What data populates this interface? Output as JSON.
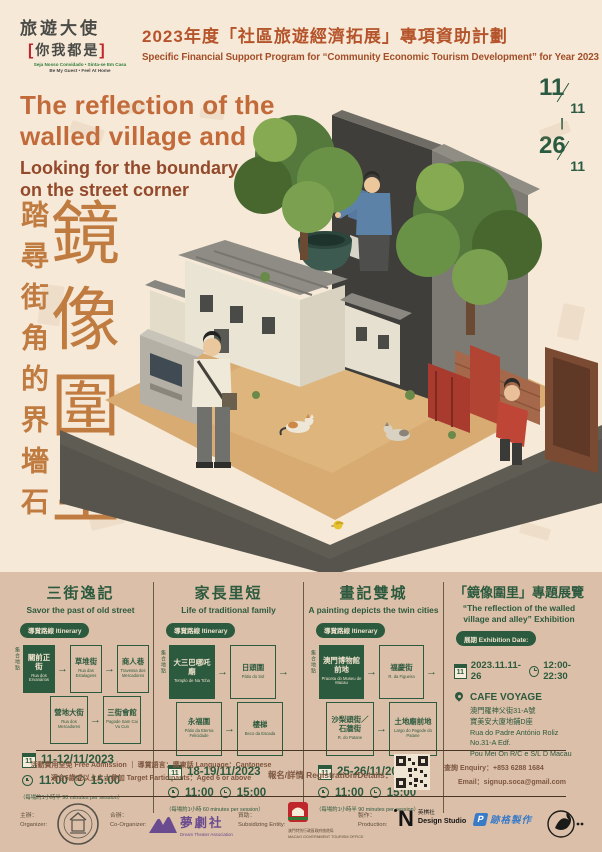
{
  "header": {
    "logo": {
      "title": "旅遊大使",
      "bracket_l": "[",
      "sub_cn": "你我都是",
      "bracket_r": "]",
      "pt": "Seja Nosso Convidado • Sinta-se Em Casa",
      "en": "Be My Guest • Feel At Home"
    },
    "title_cn": "2023年度「社區旅遊經濟拓展」專項資助計劃",
    "title_en": "Specific Financial Support Program for “Community Economic Tourism Development” for Year 2023"
  },
  "hero": {
    "title_line1": "The reflection of the",
    "title_line2": "walled village and alley",
    "subtitle_line1": "Looking for the boundary stone",
    "subtitle_line2": "on the street corner",
    "vertical_sub": "踏尋街角的界墻石",
    "vertical_main": "鏡像圍里",
    "date": {
      "d1": "11",
      "m1": "11",
      "sep": "|",
      "d2": "26",
      "m2": "11"
    }
  },
  "misc": {
    "arrow": "→",
    "calendar_day": "11"
  },
  "sections": {
    "col1": {
      "title_cn": "三街逸記",
      "title_en": "Savor the past of old street",
      "badge": "導賞路線 Itinerary",
      "meeting_label": "集合地點",
      "row1": [
        {
          "cn": "關前正街",
          "latin": "Rua dos Ervanários"
        },
        {
          "cn": "草堆街",
          "latin": "Rua das Estalagens"
        },
        {
          "cn": "商人巷",
          "latin": "Travessa dos Mercadores"
        }
      ],
      "row2": [
        {
          "cn": "營地大街",
          "latin": "Rua dos Mercadores"
        },
        {
          "cn": "三街會館",
          "latin": "Pagode Sam Cai Vu Cun"
        }
      ],
      "date": "11-12/11/2023",
      "time1": "11:00",
      "time2": "15:00",
      "note": "（每場約1小時半 90 minutes per session）"
    },
    "col2": {
      "title_cn": "家長里短",
      "title_en": "Life of traditional family",
      "badge": "導賞路線 Itinerary",
      "meeting_label": "集合地點",
      "row1": [
        {
          "cn": "大三巴哪吒廟",
          "latin": "Templo de Na Tcha"
        },
        {
          "cn": "日頭圍",
          "latin": "Pátio do Sol"
        }
      ],
      "row2": [
        {
          "cn": "永福圍",
          "latin": "Pátio da Eterna Felicidade"
        },
        {
          "cn": "樓梯",
          "latin": "Beco da Escada"
        }
      ],
      "date": "18-19/11/2023",
      "time1": "11:00",
      "time2": "15:00",
      "note": "（每場約1小時 60 minutes per session）"
    },
    "col3": {
      "title_cn": "畫記雙城",
      "title_en": "A painting depicts the twin cities",
      "badge": "導賞路線 Itinerary",
      "meeting_label": "集合地點",
      "row1": [
        {
          "cn": "澳門博物館前地",
          "latin": "Praceta do Museu de Macau"
        },
        {
          "cn": "福慶街",
          "latin": "R. da Figueira"
        }
      ],
      "row2": [
        {
          "cn": "沙梨頭街／石牆街",
          "latin": "R. do Patane"
        },
        {
          "cn": "土地廟前地",
          "latin": "Largo do Pagode do Patane"
        }
      ],
      "date": "25-26/11/2023",
      "time1": "11:00",
      "time2": "15:00",
      "note": "（每場約1小時半 90 minutes per session）"
    },
    "col4": {
      "title_cn": "「鏡像圍里」專題展覽",
      "title_en_line1": "“The reflection of the walled",
      "title_en_line2": "village and alley” Exhibition",
      "badge": "展期 Exhibition Date:",
      "date": "2023.11.11-26",
      "time": "12:00-22:30",
      "venue": "CAFE VOYAGE",
      "addr_cn1": "澳門羅神父街31-A號",
      "addr_cn2": "寶美安大廈地鋪D座",
      "addr_pt1": "Rua do Padre António Roliz",
      "addr_pt2": "No.31-A Edf.",
      "addr_pt3": "Pou Mei On R/C e S/L D Macau"
    }
  },
  "registration": {
    "line1": "活動費用全免 Free Admission ｜ 導賞語言：廣東話 Language：Cantonese",
    "line2": "適合6歲或以上人士參加 Target Participants：Aged 6 or above",
    "reg_label": "報名/詳情 Registration/Details：",
    "enquiry": "查詢 Enquiry：+853 6288 1684",
    "email": "Email：signup.soca@gmail.com"
  },
  "footer": {
    "organizer_cn": "主辦：",
    "organizer_en": "Organizer:",
    "coorganizer_cn": "合辦：",
    "coorganizer_en": "Co-Organizer:",
    "coorganizer_name_cn": "夢劇社",
    "coorganizer_name_en": "Dream Theater Association",
    "subsidy_cn": "資助：",
    "subsidy_en": "Subsidizing Entity:",
    "subsidy_name_cn": "澳門特別行政區政府旅遊局",
    "subsidy_name_en": "MACAO GOVERNMENT TOURISM OFFICE",
    "production_cn": "製作：",
    "production_en": "Production:",
    "production_name_cn": "英棋社",
    "production_name_en": "Design Studio",
    "production2_name": "跡格製作"
  },
  "colors": {
    "bg_top": "#f6e9d8",
    "bg_bottom": "#dbbfa8",
    "accent_orange": "#c26a39",
    "dark_brown": "#93492a",
    "header_orange": "#b5542b",
    "green": "#2c5a3e",
    "logo_red": "#c0272d",
    "purple": "#6a4b8f",
    "blue": "#3a7bc8"
  }
}
